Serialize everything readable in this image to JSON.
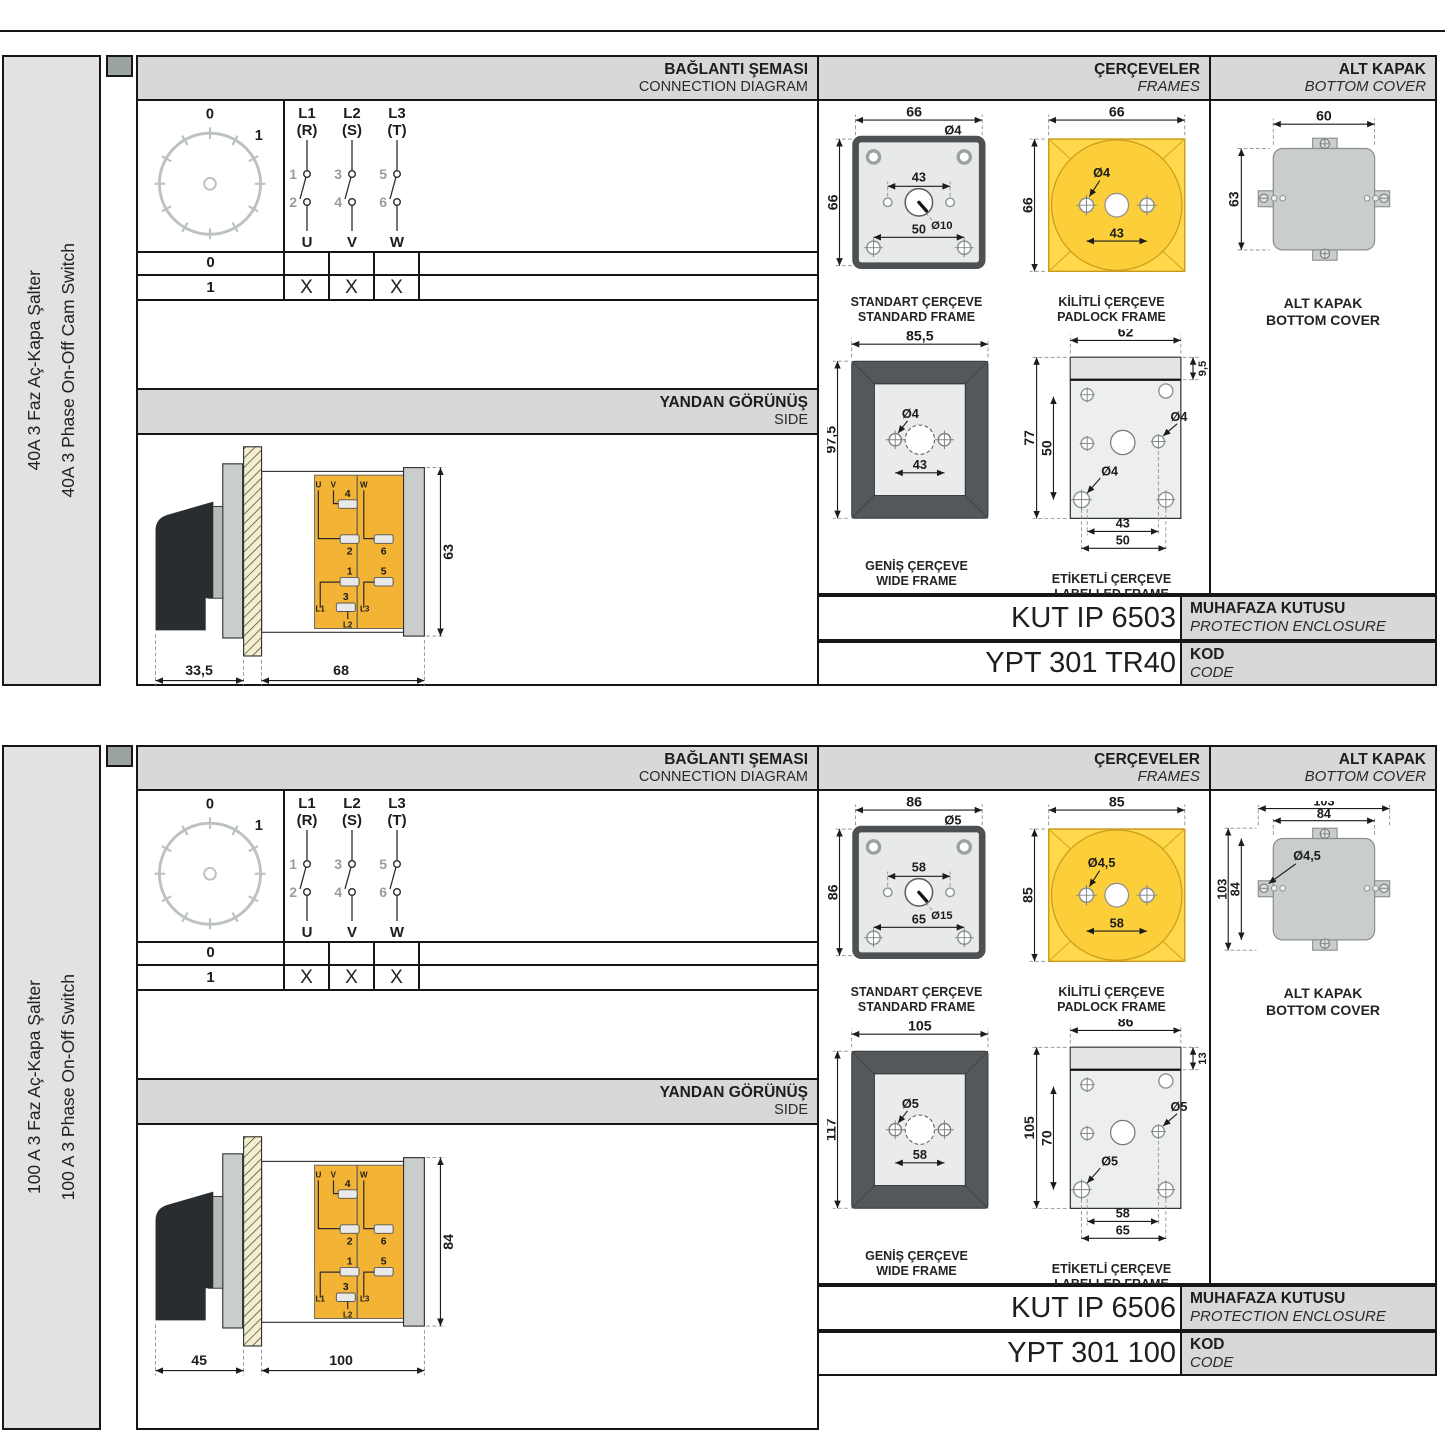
{
  "colors": {
    "accent_yellow": "#ffd94b",
    "terminal_yellow": "#f3b435",
    "band_grey": "#d8d8d8",
    "frame_dark_grey": "#54585b",
    "cover_grey": "#c9cdcc"
  },
  "shared": {
    "header_connection_tr": "BAĞLANTI ŞEMASI",
    "header_connection_en": "CONNECTION DIAGRAM",
    "header_frames_tr": "ÇERÇEVELER",
    "header_frames_en": "FRAMES",
    "header_cover_tr": "ALT KAPAK",
    "header_cover_en": "BOTTOM COVER",
    "side_view_tr": "YANDAN GÖRÜNÜŞ",
    "side_view_en": "SIDE",
    "enclosure_label_tr": "MUHAFAZA KUTUSU",
    "enclosure_label_en": "PROTECTION ENCLOSURE",
    "code_label_tr": "KOD",
    "code_label_en": "CODE",
    "captions": {
      "standard_tr": "STANDART ÇERÇEVE",
      "standard_en": "STANDARD FRAME",
      "padlock_tr": "KİLİTLİ ÇERÇEVE",
      "padlock_en": "PADLOCK FRAME",
      "wide_tr": "GENİŞ ÇERÇEVE",
      "wide_en": "WIDE FRAME",
      "labelled_tr": "ETİKETLİ ÇERÇEVE",
      "labelled_en": "LABELLED FRAME",
      "cover_tr": "ALT KAPAK",
      "cover_en": "BOTTOM COVER"
    },
    "dial": {
      "pos0": "0",
      "pos1": "1"
    },
    "contacts": {
      "p1a": "L1",
      "p1b": "(R)",
      "p2a": "L2",
      "p2b": "(S)",
      "p3a": "L3",
      "p3b": "(T)",
      "t1": "1",
      "t2": "2",
      "t3": "3",
      "t4": "4",
      "t5": "5",
      "t6": "6",
      "o1": "U",
      "o2": "V",
      "o3": "W"
    },
    "table": {
      "row0_label": "0",
      "row1_label": "1",
      "row1_marks": [
        "X",
        "X",
        "X"
      ]
    },
    "side_terminals": {
      "u": "U",
      "v": "V",
      "w": "W",
      "n4": "4",
      "n2": "2",
      "n6": "6",
      "n1": "1",
      "n3": "3",
      "n5": "5",
      "l1": "L1",
      "l2": "L2",
      "l3": "L3"
    }
  },
  "sections": [
    {
      "side_label_tr": "40A 3 Faz Aç-Kapa Şalter",
      "side_label_en": "40A 3 Phase On-Off Cam Switch",
      "cover_variant": "a",
      "side_view": {
        "dim_handle": "33,5",
        "dim_body": "68",
        "dim_height": "63"
      },
      "standard_frame": {
        "dim_top": "66",
        "hole": "Ø4",
        "dim_inner": "43",
        "center_hole": "Ø10",
        "dim_bottom": "50",
        "dim_left": "66"
      },
      "padlock_frame": {
        "dim_top": "66",
        "dim_left": "66",
        "hole": "Ø4",
        "dim_inner": "43"
      },
      "wide_frame": {
        "dim_top": "85,5",
        "dim_left": "97,5",
        "hole": "Ø4",
        "dim_inner": "43"
      },
      "labelled_frame": {
        "dim_top": "62",
        "dim_strip": "9,5",
        "dim_left": "77",
        "dim_inner_v": "50",
        "hole_right": "Ø4",
        "hole_left": "Ø4",
        "dim_b1": "43",
        "dim_b2": "50"
      },
      "bottom_cover": {
        "dim_top": "60",
        "dim_left": "63"
      },
      "enclosure_code": "KUT IP 6503",
      "code": "YPT 301 TR40"
    },
    {
      "side_label_tr": "100 A 3 Faz Aç-Kapa Şalter",
      "side_label_en": "100 A 3 Phase On-Off Switch",
      "cover_variant": "b",
      "side_view": {
        "dim_handle": "45",
        "dim_body": "100",
        "dim_height": "84"
      },
      "standard_frame": {
        "dim_top": "86",
        "hole": "Ø5",
        "dim_inner": "58",
        "center_hole": "Ø15",
        "dim_bottom": "65",
        "dim_left": "86"
      },
      "padlock_frame": {
        "dim_top": "85",
        "dim_left": "85",
        "hole": "Ø4,5",
        "dim_inner": "58"
      },
      "wide_frame": {
        "dim_top": "105",
        "dim_left": "117",
        "hole": "Ø5",
        "dim_inner": "58"
      },
      "labelled_frame": {
        "dim_top": "86",
        "dim_strip": "13",
        "dim_left": "105",
        "dim_inner_v": "70",
        "hole_right": "Ø5",
        "hole_left": "Ø5",
        "dim_b1": "58",
        "dim_b2": "65"
      },
      "bottom_cover": {
        "dim_outer_w": "103",
        "dim_inner_w": "84",
        "dim_outer_h": "103",
        "dim_inner_h": "84",
        "hole": "Ø4,5"
      },
      "enclosure_code": "KUT IP 6506",
      "code": "YPT 301 100"
    }
  ]
}
